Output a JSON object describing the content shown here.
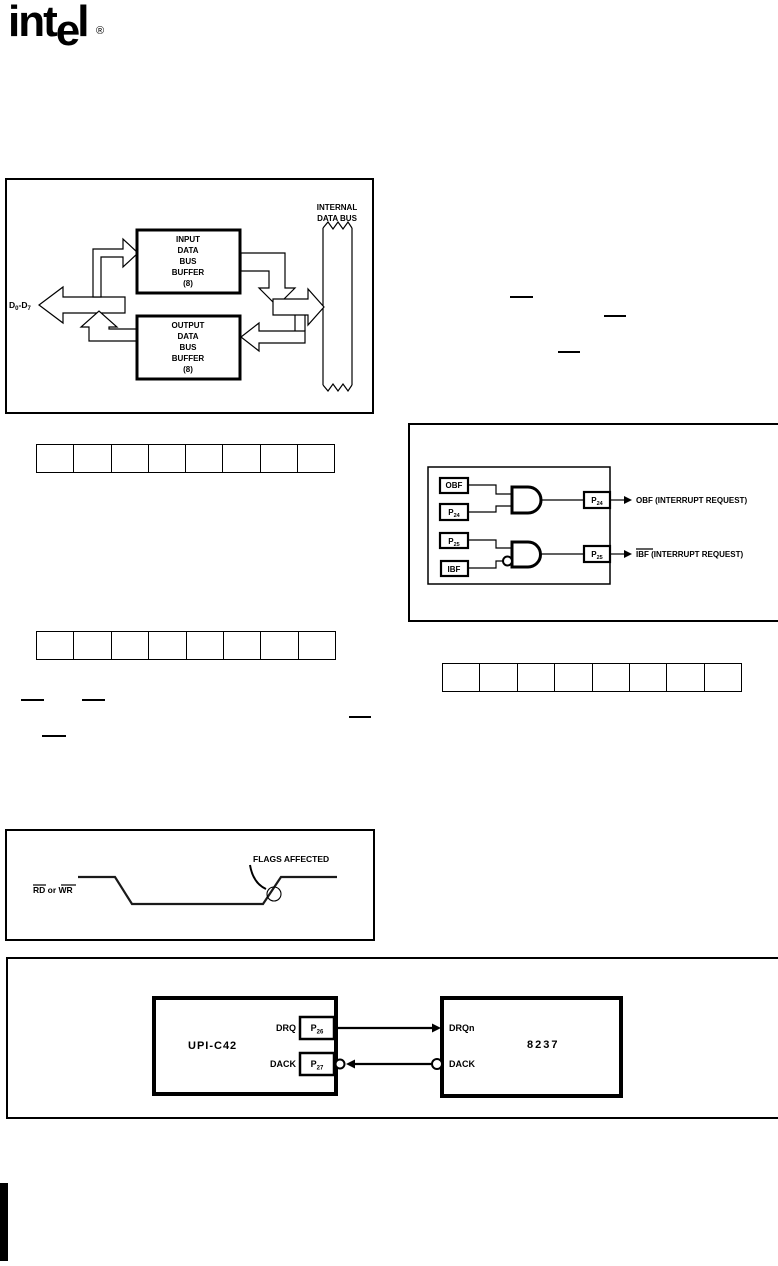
{
  "logo": {
    "part1": "int",
    "part2": "e",
    "part3": "l",
    "registered": "®"
  },
  "fig_data_bus": {
    "bus_label": [
      "INTERNAL",
      "DATA BUS"
    ],
    "input_buffer": [
      "INPUT",
      "DATA",
      "BUS",
      "BUFFER",
      "(8)"
    ],
    "output_buffer": [
      "OUTPUT",
      "DATA",
      "BUS",
      "BUFFER",
      "(8)"
    ],
    "pins": {
      "d": "D",
      "sub0": "0",
      "dash_d": "-D",
      "sub7": "7"
    }
  },
  "registers": {
    "row1_cells": 8,
    "row2_cells": 8,
    "row3_cells": 8
  },
  "fig_interrupt": {
    "flag_obf": "OBF",
    "flag_p24": {
      "p": "P",
      "sub": "24"
    },
    "flag_p25": {
      "p": "P",
      "sub": "25"
    },
    "flag_ibf": "IBF",
    "out_p24": {
      "p": "P",
      "sub": "24"
    },
    "out_p25": {
      "p": "P",
      "sub": "25"
    },
    "obf_request_label": "OBF (INTERRUPT REQUEST)",
    "ibf_request_overlined": "IBF",
    "ibf_request_rest": " (INTERRUPT REQUEST)"
  },
  "fig_timing": {
    "rd": "RD",
    "or": " or ",
    "wr": "WR",
    "annotation": "FLAGS AFFECTED"
  },
  "fig_dma": {
    "upi": "UPI-C42",
    "dma": "8237",
    "drq": "DRQ",
    "dack": "DACK",
    "p26": {
      "p": "P",
      "sub": "26"
    },
    "p27": {
      "p": "P",
      "sub": "27"
    },
    "drqn": "DRQn",
    "dack_right": "DACK"
  }
}
